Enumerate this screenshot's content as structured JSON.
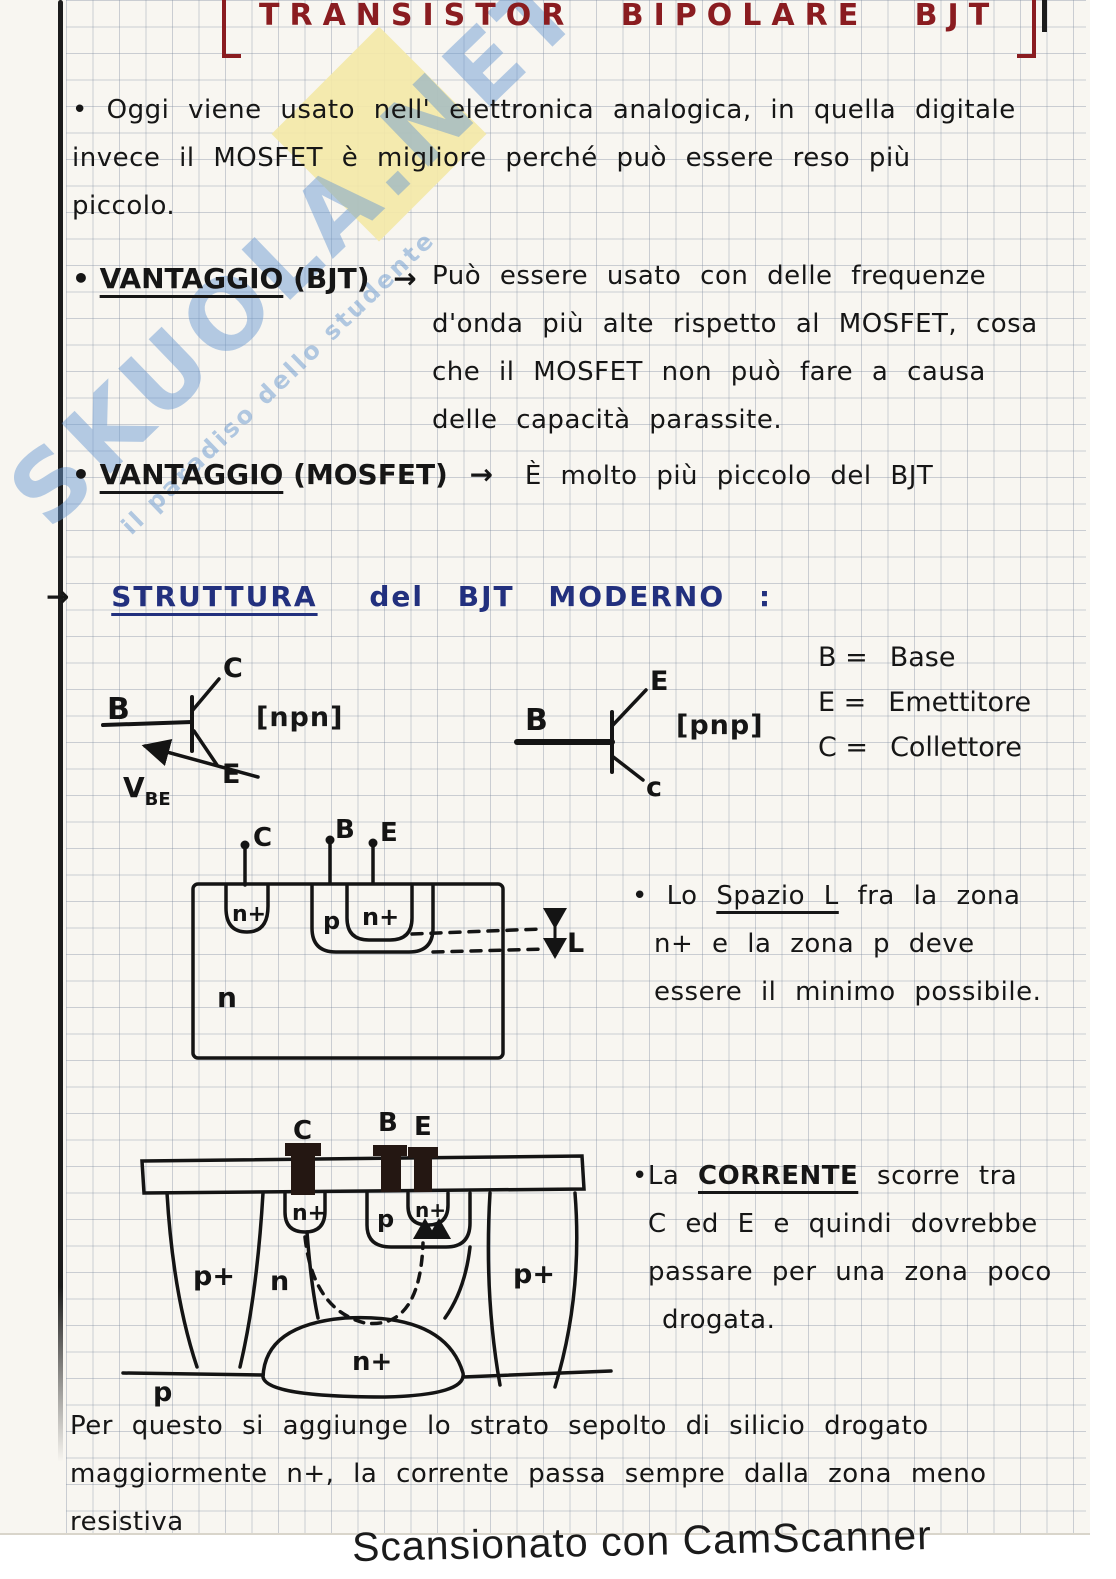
{
  "page": {
    "title": "TRANSISTOR BIPOLARE BJT",
    "footer": "Scansionato con CamScanner"
  },
  "watermark": {
    "brand": "SKUOLA.NET",
    "tagline": "il paradiso dello studente"
  },
  "intro": {
    "bullet": "•",
    "line1": "Oggi viene usato nell' elettronica analogica, in quella digitale",
    "line2": "invece il MOSFET è migliore perché può essere reso più",
    "line3": "piccolo."
  },
  "vantaggio_bjt": {
    "bullet": "•",
    "label": "VANTAGGIO",
    "device": "(BJT)",
    "arrow": "→",
    "line1": "Può essere usato con delle frequenze",
    "line2": "d'onda più alte rispetto al MOSFET, cosa",
    "line3": "che il MOSFET non può fare a causa",
    "line4": "delle capacità parassite."
  },
  "vantaggio_mosfet": {
    "bullet": "•",
    "label": "VANTAGGIO",
    "device": "(MOSFET)",
    "arrow": "→",
    "text": "È molto più piccolo del BJT"
  },
  "struttura": {
    "arrow": "→",
    "title": "STRUTTURA",
    "rest": "del BJT MODERNO :"
  },
  "symbols": {
    "npn": {
      "tag": "[npn]",
      "b": "B",
      "c": "C",
      "e": "E",
      "v": "V",
      "v_sub": "BE"
    },
    "pnp": {
      "tag": "[pnp]",
      "b": "B",
      "c": "c",
      "e": "E"
    },
    "legend": {
      "b_key": "B =",
      "b_val": "Base",
      "e_key": "E =",
      "e_val": "Emettitore",
      "c_key": "C =",
      "c_val": "Collettore"
    }
  },
  "cs1": {
    "c": "C",
    "b": "B",
    "e": "E",
    "nplus_c": "n+",
    "p": "p",
    "nplus_e": "n+",
    "n": "n",
    "dim": "L"
  },
  "note_spazio": {
    "bullet": "•",
    "l1_pre": "Lo ",
    "l1_u": "Spazio L",
    "l1_post": " fra la zona",
    "l2": "n+ e la zona p deve",
    "l3": "essere il minimo possibile."
  },
  "cs2": {
    "c": "C",
    "b": "B",
    "e": "E",
    "nplus_c": "n+",
    "p_base": "p",
    "nplus_e": "n+",
    "pplus_left": "p+",
    "pplus_right": "p+",
    "n": "n",
    "nplus_buried": "n+",
    "p_sub": "p"
  },
  "note_corrente": {
    "bullet": "•",
    "l1_pre": "La ",
    "l1_u": "CORRENTE",
    "l1_post": " scorre tra",
    "l2": "C ed E e quindi dovrebbe",
    "l3": "passare per una zona poco",
    "l4": "drogata."
  },
  "closing": {
    "line1": "Per questo si aggiunge lo strato sepolto di silicio drogato",
    "line2": "maggiormente n+, la corrente passa sempre dalla zona meno",
    "line3": "resistiva"
  }
}
